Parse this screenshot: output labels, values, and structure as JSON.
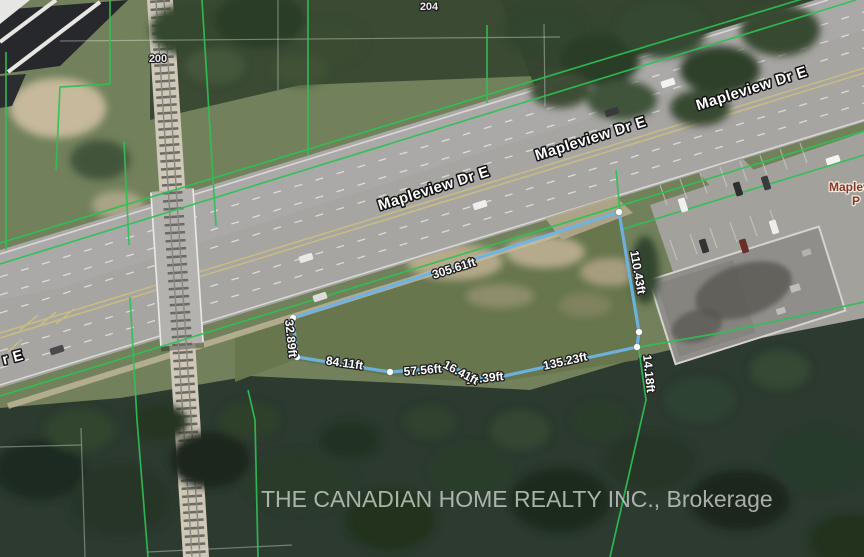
{
  "map": {
    "type": "aerial-parcel-map",
    "road": {
      "name": "Mapleview Dr E",
      "labels": [
        "Mapleview Dr E",
        "Mapleview Dr E",
        "Mapleview Dr E"
      ],
      "partial_label": "r E"
    },
    "addresses": [
      "204",
      "200"
    ],
    "poi": {
      "line1": "Maplev",
      "line2": "P"
    },
    "parcel": {
      "line_color": "#6db4e6",
      "vertex_color": "#ffffff",
      "measurements": {
        "north": "305.61ft",
        "east_upper": "110.43ft",
        "east_lower": "14.18ft",
        "south_east": "135.23ft",
        "south_mid_right": "19.39ft",
        "south_mid": "16.41ft",
        "south_mid_left": "57.56ft",
        "south_west": "84.11ft",
        "west": "32.89ft"
      }
    },
    "boundary_color": "#2ec155",
    "watermark": "THE CANADIAN HOME REALTY INC., Brokerage"
  }
}
